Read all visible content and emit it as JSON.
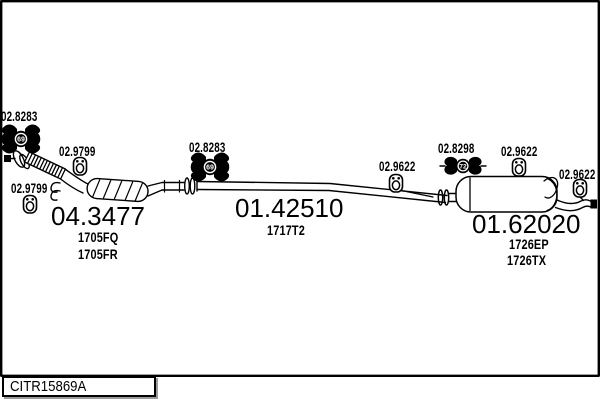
{
  "colors": {
    "ink": "#000000",
    "paper": "#ffffff"
  },
  "frame": {
    "drawing_code": "CITR15869A"
  },
  "parts": {
    "catalyst": {
      "number": "04.3477",
      "ref1": "1705FQ",
      "ref2": "1705FR"
    },
    "mid_pipe": {
      "number": "01.42510",
      "ref1": "1717T2"
    },
    "rear_muffler": {
      "number": "01.62020",
      "ref1": "1726EP",
      "ref2": "1726TX"
    }
  },
  "fittings": {
    "gasket_front": {
      "number": "02.8283",
      "badge": "69"
    },
    "gasket_mid": {
      "number": "02.8283",
      "badge": "69"
    },
    "hanger_front_upper": {
      "number": "02.9799"
    },
    "hanger_front_lower": {
      "number": "02.9799"
    },
    "hanger_mid": {
      "number": "02.9622"
    },
    "clamp_rear": {
      "number": "02.8298",
      "badge": "72"
    },
    "hanger_rear_top": {
      "number": "02.9622"
    },
    "hanger_tail": {
      "number": "02.9622"
    }
  }
}
